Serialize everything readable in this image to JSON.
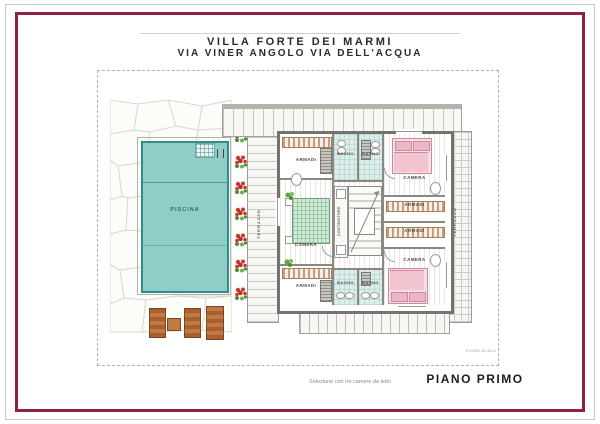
{
  "title": {
    "line1": "VILLA FORTE DEI MARMI",
    "line2": "VIA VINER ANGOLO VIA DELL'ACQUA"
  },
  "plan": {
    "pool_label": "PISCINA",
    "labels": {
      "camera": "CAMERA",
      "armadi": "ARMADI",
      "bagno": "BAGNO",
      "terrazzo": "TERRAZZO",
      "contenitore": "CONTENITORE"
    },
    "scale_note": "FUORI SCALA"
  },
  "footer": {
    "caption": "Soluzione con tre camere da letto",
    "plan_name": "PIANO PRIMO"
  },
  "colors": {
    "frame_accent": "#8f2240",
    "pool": "#8fcdc9",
    "pool_border": "#2e8f8a",
    "bath_floor": "#dbeeea",
    "bed_pink": "#f3c9d4",
    "bed_green": "#cfe9d4",
    "flower_red": "#c23b2e",
    "leaf_green": "#4e8a3a",
    "lounger_brown": "#b06a33",
    "wardrobe_stripe": "#c79d7f"
  }
}
